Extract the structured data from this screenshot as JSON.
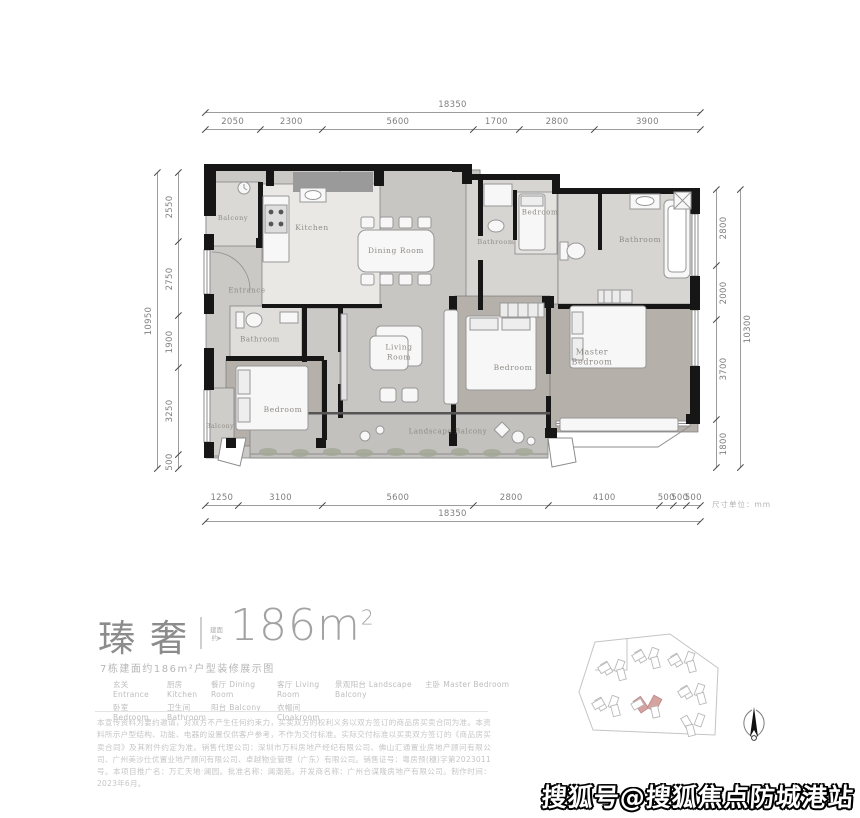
{
  "floor_plan": {
    "unit_note": "尺寸单位：mm",
    "dims_top": {
      "total": "18350",
      "segments": [
        "2050",
        "2300",
        "5600",
        "1700",
        "2800",
        "3900"
      ]
    },
    "dims_bottom": {
      "total": "18350",
      "segments": [
        "1250",
        "3100",
        "5600",
        "2800",
        "4100",
        "500",
        "500",
        "500"
      ]
    },
    "dims_left": {
      "total": "10950",
      "segments": [
        "2550",
        "2750",
        "1900",
        "3250",
        "500"
      ]
    },
    "dims_right": {
      "total": "10300",
      "segments": [
        "2800",
        "2000",
        "3700",
        "1800"
      ]
    },
    "rooms": {
      "balcony_top": "Balcony",
      "kitchen": "Kitchen",
      "dining": "Dining Room",
      "entrance": "Entrance",
      "bath_mid_top": "Bathroom",
      "bedroom_top": "Bedroom",
      "bath_right_top": "Bathroom",
      "bath_left": "Bathroom",
      "bedroom_left": "Bedroom",
      "living": "Living Room",
      "bedroom_mid": "Bedroom",
      "master": "Master Bedroom",
      "landscape_balcony": "Landscape Balcony",
      "balcony_bottom": "Balcony"
    }
  },
  "info": {
    "title": "瑧奢",
    "area_badge_line1": "建面",
    "area_badge_line2": "约▸",
    "area_value": "186m",
    "area_sup": "2",
    "subtitle": "7栋建面约186m²户型装修展示图",
    "legend_row1": [
      "玄关 Entrance",
      "厨房 Kitchen",
      "餐厅 Dining Room",
      "客厅 Living Room",
      "景观阳台 Landscape Balcony",
      "主卧 Master Bedroom"
    ],
    "legend_row2": [
      "卧室 Bedroom",
      "卫生间 Bathroom",
      "阳台 Balcony",
      "衣帽间 Cloakroom"
    ],
    "disclaimer": "本宣传资料为要约邀请，对双方不产生任何约束力，买卖双方的权利义务以双方签订的商品房买卖合同为准。本资料所示户型结构、功能、电器的设置仅供客户参考，不作为交付标准。实际交付标准以买卖双方签订的《商品房买卖合同》及其附件约定为准。销售代理公司：深圳市万科房地产经纪有限公司、佛山汇通置业房地产顾问有限公司、广州美沙仕优置业地产顾问有限公司、卓越物业管理（广东）有限公司。销售证号：粤房预(穗)字第2023011号。本项目推广名：万汇天地·澜园。批准名称：澜潮苑。开发商名称：广州合谋隆房地产有限公司。制作时间：2023年6月。"
  },
  "watermark": "搜狐号@搜狐焦点防城港站",
  "colors": {
    "wall": "#161616",
    "marble_floor": "#cbc9c6",
    "wood_floor": "#b5b0aa",
    "highlight_building": "#d5a3a0",
    "dim_text": "#7f7f7f"
  }
}
